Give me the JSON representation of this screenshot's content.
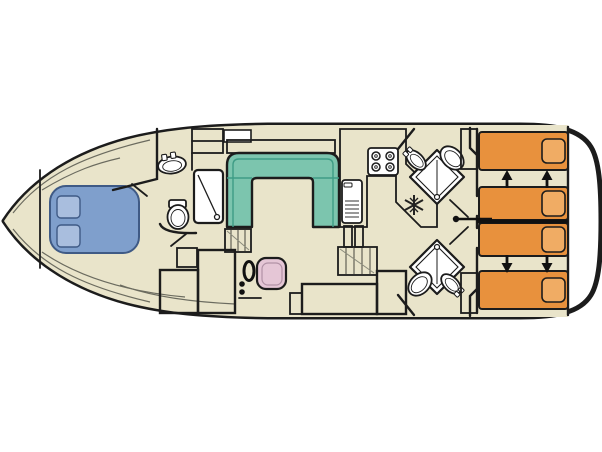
{
  "app": {
    "type": "boat-floor-plan",
    "description": "Top-down deck plan of a canal cruiser houseboat, bow at left, stern at right"
  },
  "canvas": {
    "width": 602,
    "height": 452
  },
  "colors": {
    "background": "#ffffff",
    "hull_outline": "#1c1c1c",
    "floor": "#e9e4ca",
    "cabinet_gray": "#d6d3c3",
    "stairs_gray": "#dedbcc",
    "sofa_green": "#7cc5ae",
    "sofa_line": "#3e9c85",
    "bed_blue": "#7f9fcc",
    "pillow_blue": "#a9bede",
    "bed_blue_line": "#3f5a85",
    "bed_orange": "#e8913d",
    "pillow_orange": "#f0ac64",
    "seat_pink": "#e5c6d6",
    "fixture_white": "#ffffff",
    "arrow_black": "#111111"
  },
  "rooms": [
    {
      "name": "bow-owner-cabin",
      "furniture": [
        "double-bed",
        "pillow",
        "pillow"
      ]
    },
    {
      "name": "forward-bathroom",
      "furniture": [
        "wash-basin",
        "toilet",
        "shower",
        "wardrobe-shelves"
      ]
    },
    {
      "name": "saloon",
      "furniture": [
        "u-shaped-sofa",
        "sideboard",
        "companionway-stairs"
      ]
    },
    {
      "name": "helm-station",
      "furniture": [
        "steering-wheel",
        "control-knobs",
        "helm-seat",
        "console-cabinet",
        "wardrobe-cabinet",
        "step"
      ]
    },
    {
      "name": "galley",
      "furniture": [
        "four-burner-stove",
        "sink-with-drainer",
        "refrigerator",
        "companionway-stairs"
      ]
    },
    {
      "name": "starboard-aft-bathroom",
      "furniture": [
        "corner-shower",
        "toilet",
        "wash-basin"
      ]
    },
    {
      "name": "port-aft-bathroom",
      "furniture": [
        "corner-shower",
        "toilet",
        "wash-basin"
      ]
    },
    {
      "name": "aft-cabin",
      "furniture": [
        "single-bed-1",
        "single-bed-2",
        "single-bed-3",
        "single-bed-4",
        "wardrobe",
        "wardrobe",
        "slide-arrows",
        "bed-partition-handle"
      ]
    }
  ]
}
